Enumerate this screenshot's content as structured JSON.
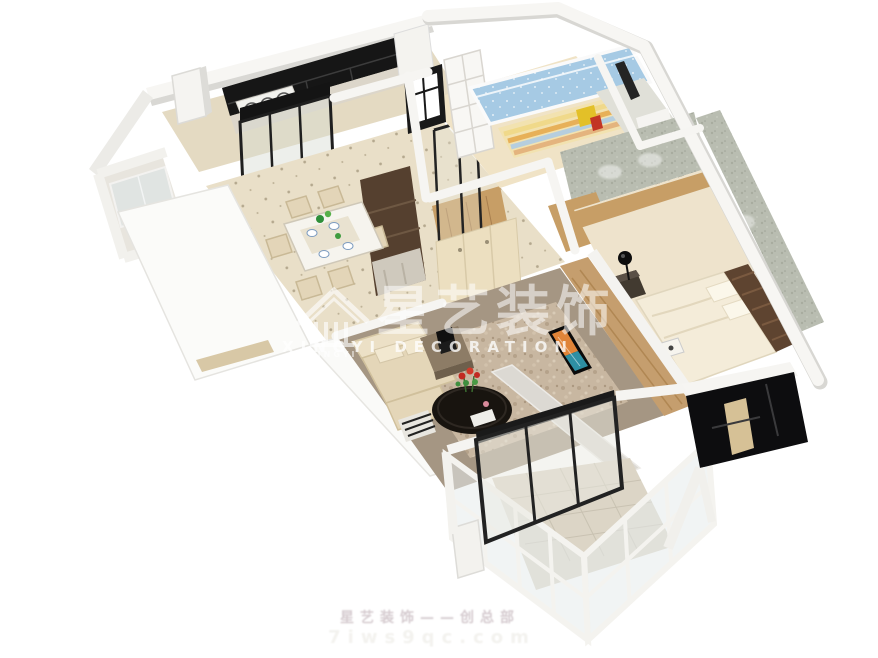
{
  "image": {
    "kind": "3d-floor-plan-render",
    "background": "#ffffff"
  },
  "watermark": {
    "logo": {
      "icon": "pavilion-house-icon",
      "text": "XINGYI"
    },
    "cn_large": "星艺装饰",
    "latin": "XINGYI DECORATION",
    "bottom_line1": "星艺装饰——创总部",
    "bottom_line2": "7iws9qc.com"
  },
  "colors": {
    "black_cabinet": "#161616",
    "blue_mattress": "#a6cae4",
    "wood_wall": "#c59e6e",
    "headboard": "#5e4430",
    "living_floor": "#a59683",
    "tv_orange": "#e08438",
    "tv_teal": "#2e8fa3",
    "texture_wall": "#b9bdb1",
    "carpet": "#eee3cc",
    "tile": "#e9dfc8"
  },
  "scene": {
    "rooms": [
      {
        "name": "kitchen"
      },
      {
        "name": "utility-bathroom"
      },
      {
        "name": "dining-room"
      },
      {
        "name": "hallway"
      },
      {
        "name": "kids-bedroom"
      },
      {
        "name": "bathroom"
      },
      {
        "name": "master-bedroom"
      },
      {
        "name": "living-room"
      },
      {
        "name": "balcony"
      }
    ]
  }
}
